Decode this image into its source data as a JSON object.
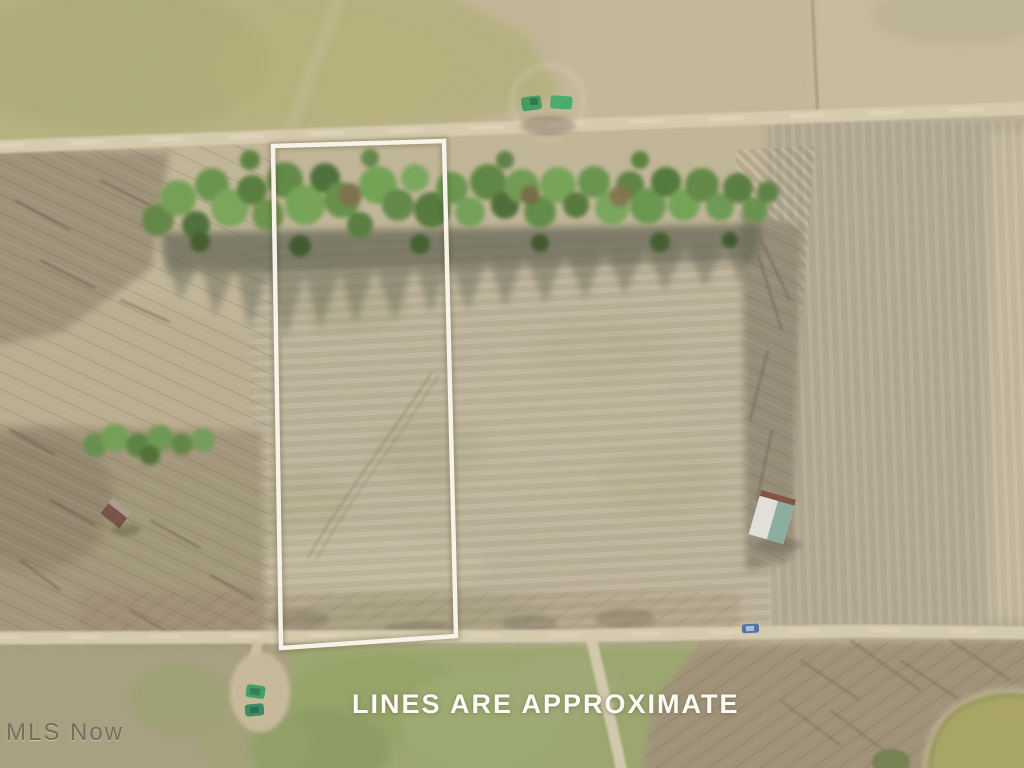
{
  "overlay": {
    "caption": "LINES ARE APPROXIMATE",
    "watermark": "MLS Now"
  },
  "image": {
    "type": "aerial-drone-photo-of-vacant-land",
    "features": [
      "property-boundary-outline",
      "tree-line-hedgerow",
      "tree-shadow",
      "dirt-road-top",
      "dirt-road-bottom",
      "south-branch-driveway",
      "left-woods",
      "right-crop-field",
      "central-mowed-field",
      "green-grass-field",
      "pond",
      "small-pond",
      "shed-white-teal-roof",
      "small-outbuilding",
      "green-farm-equipment",
      "green-vehicles",
      "blue-car"
    ]
  },
  "colors": {
    "boundary_outline": "#f7f3e8",
    "caption_text": "#fbfaf4",
    "watermark_text": "#615d4e",
    "field_tan": "#c3b697",
    "field_yellow_green": "#b6b17b",
    "tree_green": "#5e8f3f",
    "grass_green": "#95a465",
    "pond_olive": "#a6a25a",
    "road_gravel": "#dbcfb0",
    "woods_brown": "#9b8c72"
  }
}
